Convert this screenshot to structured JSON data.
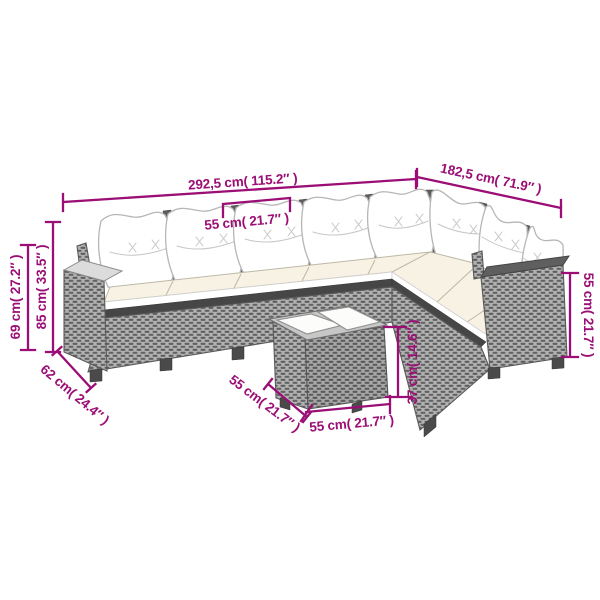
{
  "colors": {
    "accent": "#9b0e75",
    "rattan": "#b4b4b4",
    "weave": "#5e5e5e",
    "outline": "#5a5a5a",
    "cushion_white": "#ffffff",
    "seat_cream": "#f7f2e3",
    "dark_band": "#464646",
    "background": "#ffffff"
  },
  "dimensions": {
    "sofa_total_width": "292,5 cm( 115.2″ )",
    "sofa_right_width": "182,5 cm( 71.9″ )",
    "seat_width": "55 cm( 21.7″ )",
    "height_with_cushions": "85 cm( 33.5″ )",
    "height_backrest": "69 cm( 27.2″ )",
    "sofa_depth": "62 cm( 24.4″ )",
    "right_section_height": "55 cm( 21.7″ )",
    "table_height": "37 cm( 14.6″ )",
    "table_depth": "55 cm( 21.7″ )",
    "table_width": "55 cm( 21.7″ )"
  }
}
